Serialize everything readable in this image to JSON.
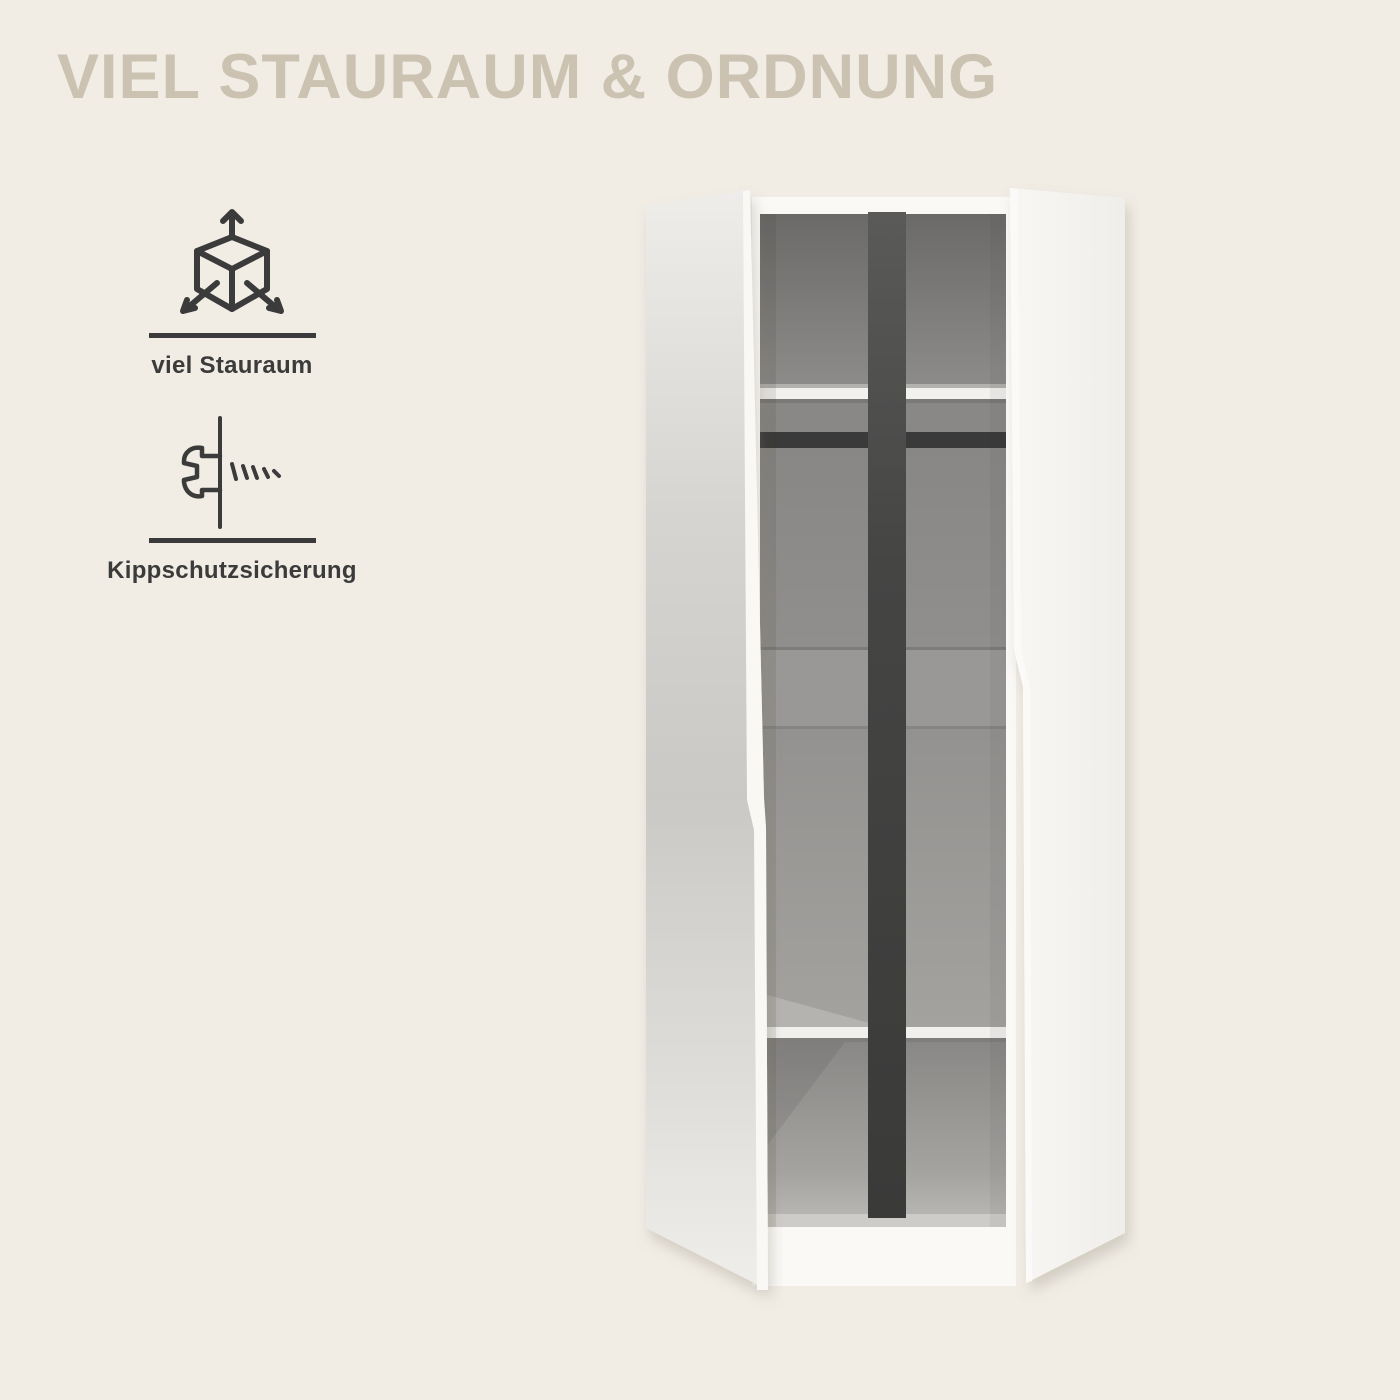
{
  "page": {
    "background_color": "#f1ede5",
    "width": 1400,
    "height": 1400
  },
  "header": {
    "title": "VIEL STAURAUM & ORDNUNG",
    "title_color": "#cbc2b2"
  },
  "features": [
    {
      "icon": "cube-3d-arrows-icon",
      "label": "viel Stauraum"
    },
    {
      "icon": "screw-anti-tip-icon",
      "label": "Kippschutzsicherung"
    }
  ],
  "product_image": {
    "subject": "two-door wardrobe shown open",
    "parts": [
      "left-door",
      "right-door",
      "center-divider",
      "top-shelf",
      "clothes-rail",
      "bottom-shelf",
      "interior-back-panel",
      "base"
    ],
    "colors": {
      "door_white": "#f3f2ef",
      "interior_grey": "#949290",
      "divider_dark": "#424241",
      "rail_dark": "#3a3a3a",
      "icon_dark": "#3b3b3b"
    }
  }
}
